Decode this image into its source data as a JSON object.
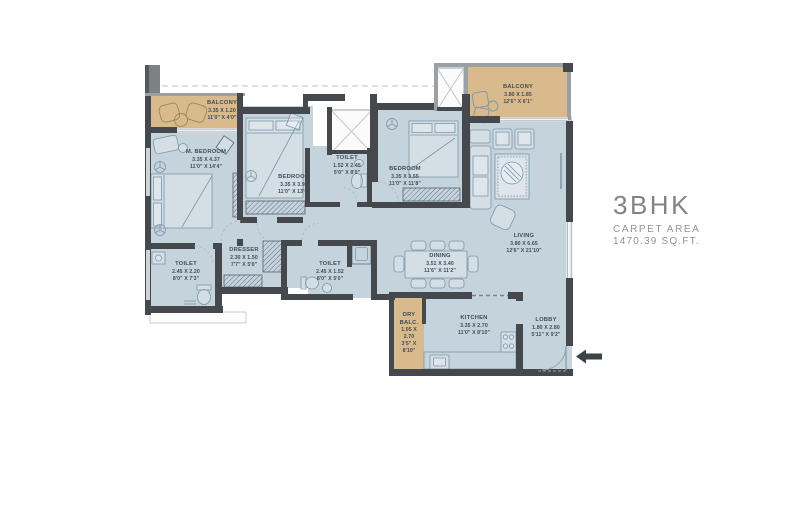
{
  "title": {
    "name": "3BHK",
    "subtitle": "CARPET AREA",
    "area": "1470.39 SQ.FT."
  },
  "rooms": [
    {
      "id": "balcony-top-left",
      "name": "BALCONY",
      "dim_m": "3.35 X 1.20",
      "dim_ft": "11'0\" X 4'0\""
    },
    {
      "id": "master-bedroom",
      "name": "M. BEDROOM",
      "dim_m": "3.35 X 4.37",
      "dim_ft": "11'0\" X 14'4\""
    },
    {
      "id": "bedroom-middle",
      "name": "BEDROOM",
      "dim_m": "3.35 X 3.95",
      "dim_ft": "11'0\" X 13'0\""
    },
    {
      "id": "toilet-top",
      "name": "TOILET",
      "dim_m": "1.52 X 2.45",
      "dim_ft": "5'0\" X 8'0\""
    },
    {
      "id": "bedroom-right",
      "name": "BEDROOM",
      "dim_m": "3.35 X 3.55",
      "dim_ft": "11'0\" X 11'8\""
    },
    {
      "id": "balcony-top-right",
      "name": "BALCONY",
      "dim_m": "3.80 X 1.85",
      "dim_ft": "12'6\" X 6'1\""
    },
    {
      "id": "living",
      "name": "LIVING",
      "dim_m": "3.80 X 6.65",
      "dim_ft": "12'6\" X 21'10\""
    },
    {
      "id": "dining",
      "name": "DINING",
      "dim_m": "3.51 X 3.40",
      "dim_ft": "11'6\" X 11'2\""
    },
    {
      "id": "dresser",
      "name": "DRESSER",
      "dim_m": "2.30 X 1.50",
      "dim_ft": "7'7\" X 5'0\""
    },
    {
      "id": "toilet-left",
      "name": "TOILET",
      "dim_m": "2.45 X 2.20",
      "dim_ft": "8'0\" X 7'3\""
    },
    {
      "id": "toilet-middle",
      "name": "TOILET",
      "dim_m": "2.45 X 1.52",
      "dim_ft": "8'0\" X 5'0\""
    },
    {
      "id": "dry-balcony",
      "name": "DRY BALC.",
      "dim_m": "1.05 X 2.70",
      "dim_ft": "3'5\" X 8'10\""
    },
    {
      "id": "kitchen",
      "name": "KITCHEN",
      "dim_m": "3.35 X 2.70",
      "dim_ft": "11'0\" X 8'10\""
    },
    {
      "id": "lobby",
      "name": "LOBBY",
      "dim_m": "1.80 X 2.80",
      "dim_ft": "5'11\" X 9'2\""
    }
  ],
  "icons": {
    "entry_arrow": "left-arrow"
  },
  "colors": {
    "floor": "#c5d3dc",
    "balcony": "#d9ba8d",
    "wall_dark": "#45484c",
    "wall_gray": "#9aa0a4",
    "furniture": "#7e96a8",
    "label_text": "#414d56",
    "title_text": "#85888b",
    "balcony_furniture": "#9b865e"
  }
}
